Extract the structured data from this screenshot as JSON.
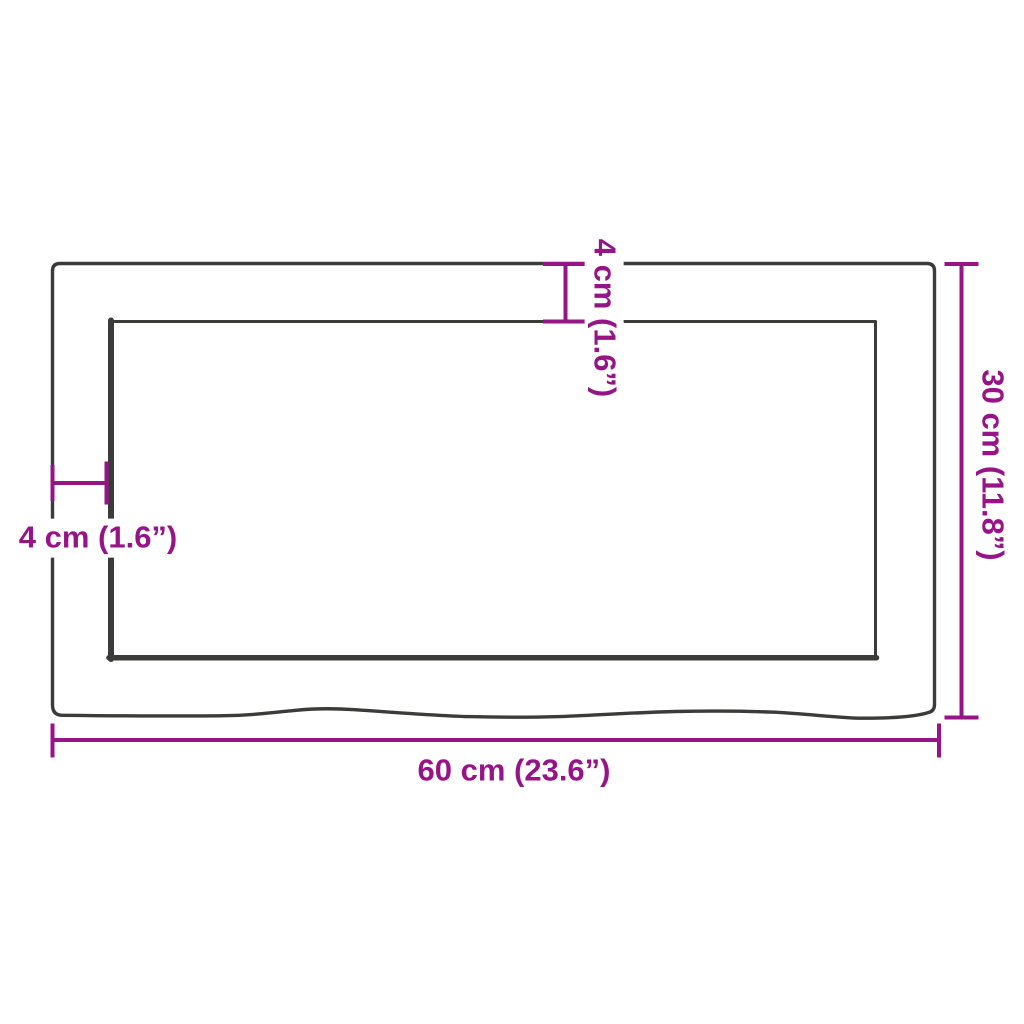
{
  "diagram": {
    "kind": "product-dimension-diagram",
    "shape": "rectangular board with wavy live bottom edge and inner offset rectangle"
  },
  "labels": {
    "width": "60 cm (23.6”)",
    "height": "30 cm (11.8”)",
    "top_offset": "4 cm (1.6”)",
    "left_offset": "4 cm (1.6”)"
  },
  "measurements": {
    "width_cm": 60,
    "width_inch": 23.6,
    "height_cm": 30,
    "height_inch": 11.8,
    "offset_cm": 4,
    "offset_inch": 1.6
  },
  "colors": {
    "dimension": "#971487",
    "outline": "#3B3B3A",
    "background": "#FFFFFF"
  }
}
